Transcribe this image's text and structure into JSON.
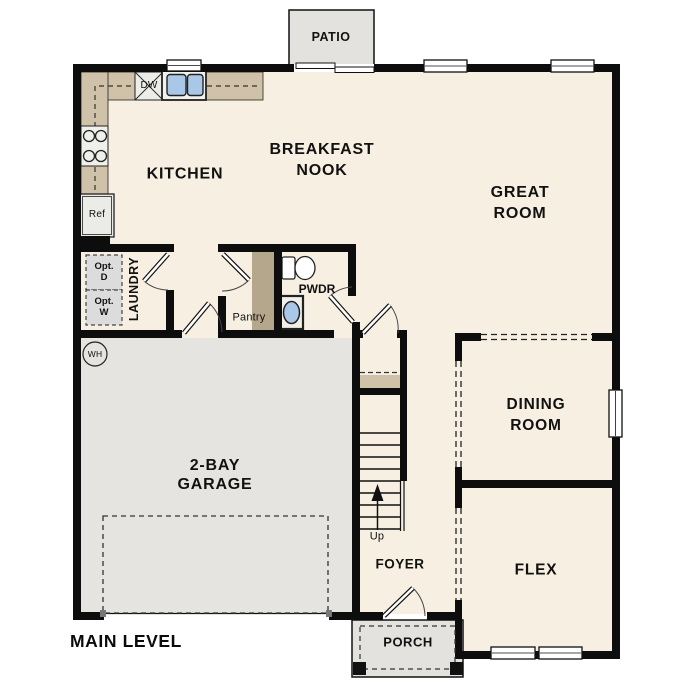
{
  "plan_title": "MAIN LEVEL",
  "colors": {
    "wall": "#0d0d0d",
    "floor_cream": "#F7EFE2",
    "garage_grey": "#E5E4E1",
    "outdoor_grey": "#E3E2DF",
    "counter_tan": "#CFC2A9",
    "pantry_tan": "#B5A78C",
    "fixture_blue": "#A9C7E7"
  },
  "rooms": {
    "patio": {
      "label": "PATIO"
    },
    "kitchen": {
      "label": "KITCHEN"
    },
    "breakfast_nook": {
      "line1": "BREAKFAST",
      "line2": "NOOK"
    },
    "great_room": {
      "line1": "GREAT",
      "line2": "ROOM"
    },
    "laundry": {
      "label": "LAUNDRY"
    },
    "pantry": {
      "label": "Pantry"
    },
    "powder": {
      "label": "PWDR"
    },
    "dining_room": {
      "line1": "DINING",
      "line2": "ROOM"
    },
    "garage": {
      "line1": "2-BAY",
      "line2": "GARAGE"
    },
    "foyer": {
      "label": "FOYER"
    },
    "flex": {
      "label": "FLEX"
    },
    "porch": {
      "label": "PORCH"
    }
  },
  "fixtures": {
    "dishwasher": "DW",
    "refrigerator": "Ref",
    "water_heater": "WH",
    "optional_dryer": {
      "line1": "Opt.",
      "line2": "D"
    },
    "optional_washer": {
      "line1": "Opt.",
      "line2": "W"
    },
    "stairs_direction": "Up"
  }
}
